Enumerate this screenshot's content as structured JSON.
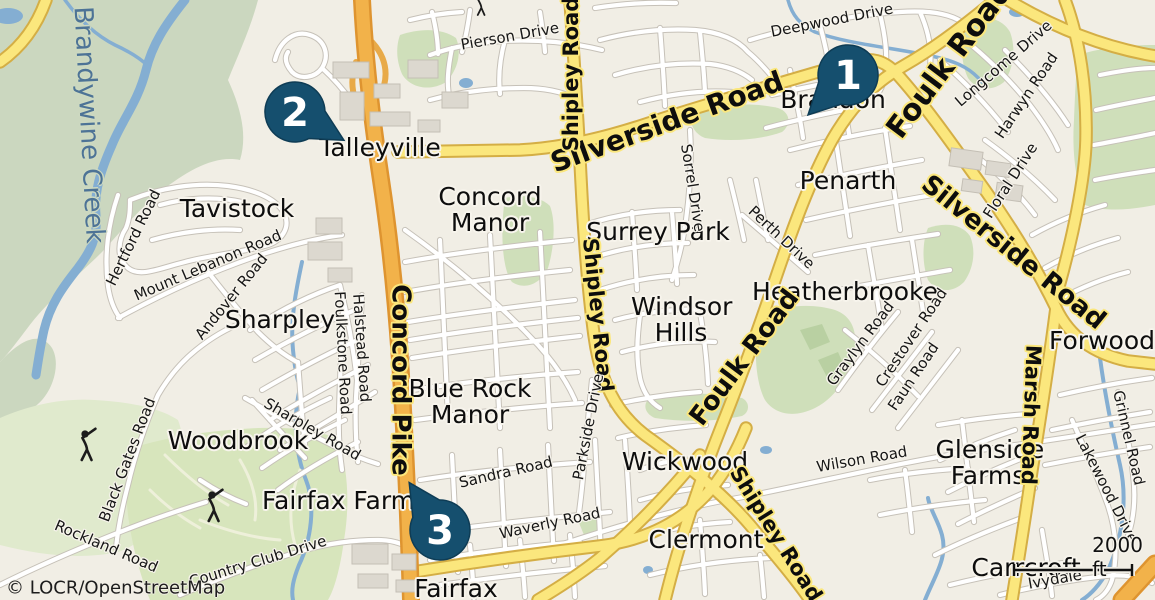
{
  "map": {
    "attribution": "© LOCR/OpenStreetMap",
    "scale_bar": {
      "label": "2000 ft"
    },
    "colors": {
      "pin": "#154f6e",
      "water": "#84aed2",
      "secondary_road": "#fbe77d",
      "trunk_road": "#f2b24a",
      "forest": "#cbd7bf",
      "golf_course": "#d7e5bc"
    },
    "markers": [
      {
        "number": "1"
      },
      {
        "number": "2"
      },
      {
        "number": "3"
      }
    ],
    "icons": {
      "golfer": "golfer-icon"
    },
    "place_labels": [
      {
        "text": "Talleyville"
      },
      {
        "text": "Tavistock"
      },
      {
        "text": "Sharpley"
      },
      {
        "text": "Concord Manor"
      },
      {
        "text": "Surrey Park"
      },
      {
        "text": "Windsor Hills"
      },
      {
        "text": "Blue Rock Manor"
      },
      {
        "text": "Woodbrook"
      },
      {
        "text": "Fairfax Farms"
      },
      {
        "text": "Fairfax"
      },
      {
        "text": "Wickwood"
      },
      {
        "text": "Clermont"
      },
      {
        "text": "Penarth"
      },
      {
        "text": "Heatherbrooke"
      },
      {
        "text": "Brandon"
      },
      {
        "text": "Forwood"
      },
      {
        "text": "Glenside Farms"
      },
      {
        "text": "Carrcroft"
      }
    ],
    "road_labels": [
      {
        "text": "Concord Pike"
      },
      {
        "text": "Silverside Road"
      },
      {
        "text": "Silverside Road"
      },
      {
        "text": "Foulk Road"
      },
      {
        "text": "Foulk Road"
      },
      {
        "text": "Shipley Road"
      },
      {
        "text": "Shipley Road"
      },
      {
        "text": "Shipley Road"
      },
      {
        "text": "Marsh Road"
      }
    ],
    "street_labels": [
      {
        "text": "Pierson Drive"
      },
      {
        "text": "Deepwood Drive"
      },
      {
        "text": "Longcome Drive"
      },
      {
        "text": "Harwyn Road"
      },
      {
        "text": "Floral Drive"
      },
      {
        "text": "Sorrel Drive"
      },
      {
        "text": "Perth Drive"
      },
      {
        "text": "Hertford Road"
      },
      {
        "text": "Mount Lebanon Road"
      },
      {
        "text": "Andover Road"
      },
      {
        "text": "Halstead Road"
      },
      {
        "text": "Foulkstone Road"
      },
      {
        "text": "Sharpley Road"
      },
      {
        "text": "Black Gates Road"
      },
      {
        "text": "Rockland Road"
      },
      {
        "text": "Country Club Drive"
      },
      {
        "text": "Sandra Road"
      },
      {
        "text": "Waverly Road"
      },
      {
        "text": "Parkside Drive"
      },
      {
        "text": "Wilson Road"
      },
      {
        "text": "Graylyn Road"
      },
      {
        "text": "Crestover Road"
      },
      {
        "text": "Faun Road"
      },
      {
        "text": "Lakewood Drive"
      },
      {
        "text": "Grinnel Road"
      },
      {
        "text": "Ivydale"
      }
    ],
    "water_labels": [
      {
        "text": "Brandywine Creek"
      }
    ]
  }
}
